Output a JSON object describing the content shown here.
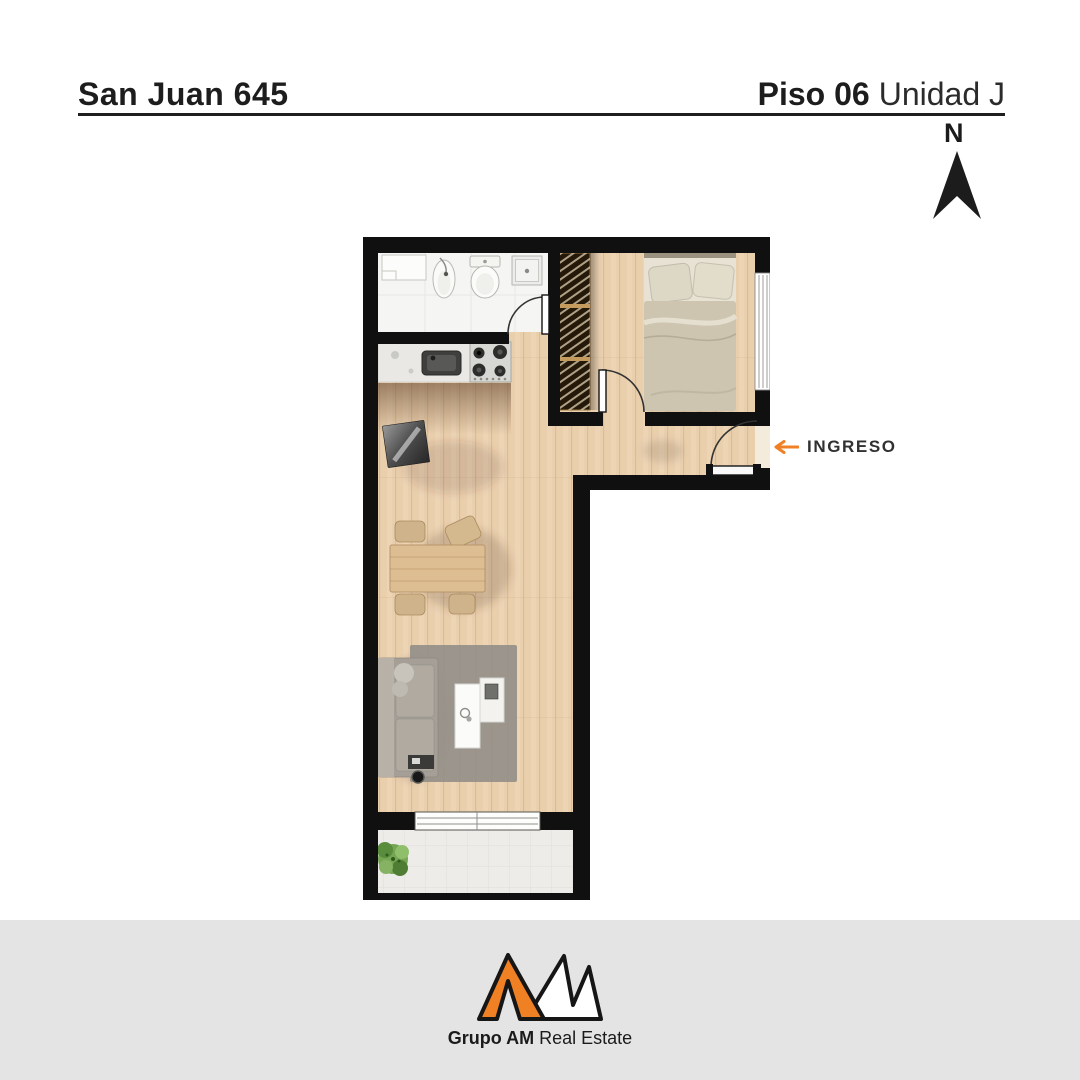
{
  "header": {
    "project": "San Juan 645",
    "floor": "Piso 06",
    "unit": "Unidad J"
  },
  "compass": {
    "label": "N"
  },
  "plan": {
    "entry_label": "INGRESO",
    "icons": {
      "compass_arrow": "north-arrow",
      "entry_arrow": "left-arrow"
    }
  },
  "footer": {
    "brand": "Grupo AM",
    "suffix": "Real Estate"
  },
  "colors": {
    "accent_orange": "#EF8023",
    "wall_black": "#101010",
    "wood_floor": "#E9CDAB",
    "bathroom_white": "#F5F5F3",
    "balcony_tile": "#EDECE8",
    "footer_gray": "#E4E4E4",
    "text_dark": "#1d1d1d"
  }
}
